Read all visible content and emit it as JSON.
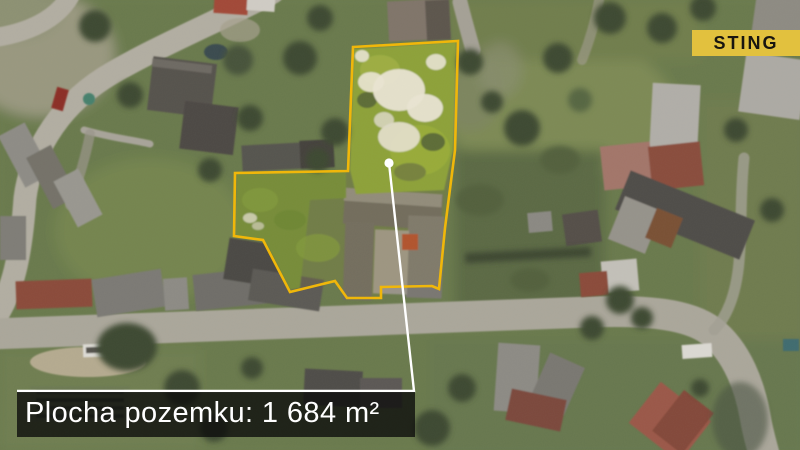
{
  "branding": {
    "logo_text": "STING"
  },
  "annotation": {
    "area_label": "Plocha pozemku: 1 684 m²"
  },
  "colors": {
    "accent-yellow": "#f0b70a",
    "badge-yellow": "#e2c13e",
    "badge-text": "#181510",
    "band-bg": "rgba(12,12,12,0.78)",
    "band-text": "#ffffff",
    "pointer-white": "#ffffff"
  }
}
